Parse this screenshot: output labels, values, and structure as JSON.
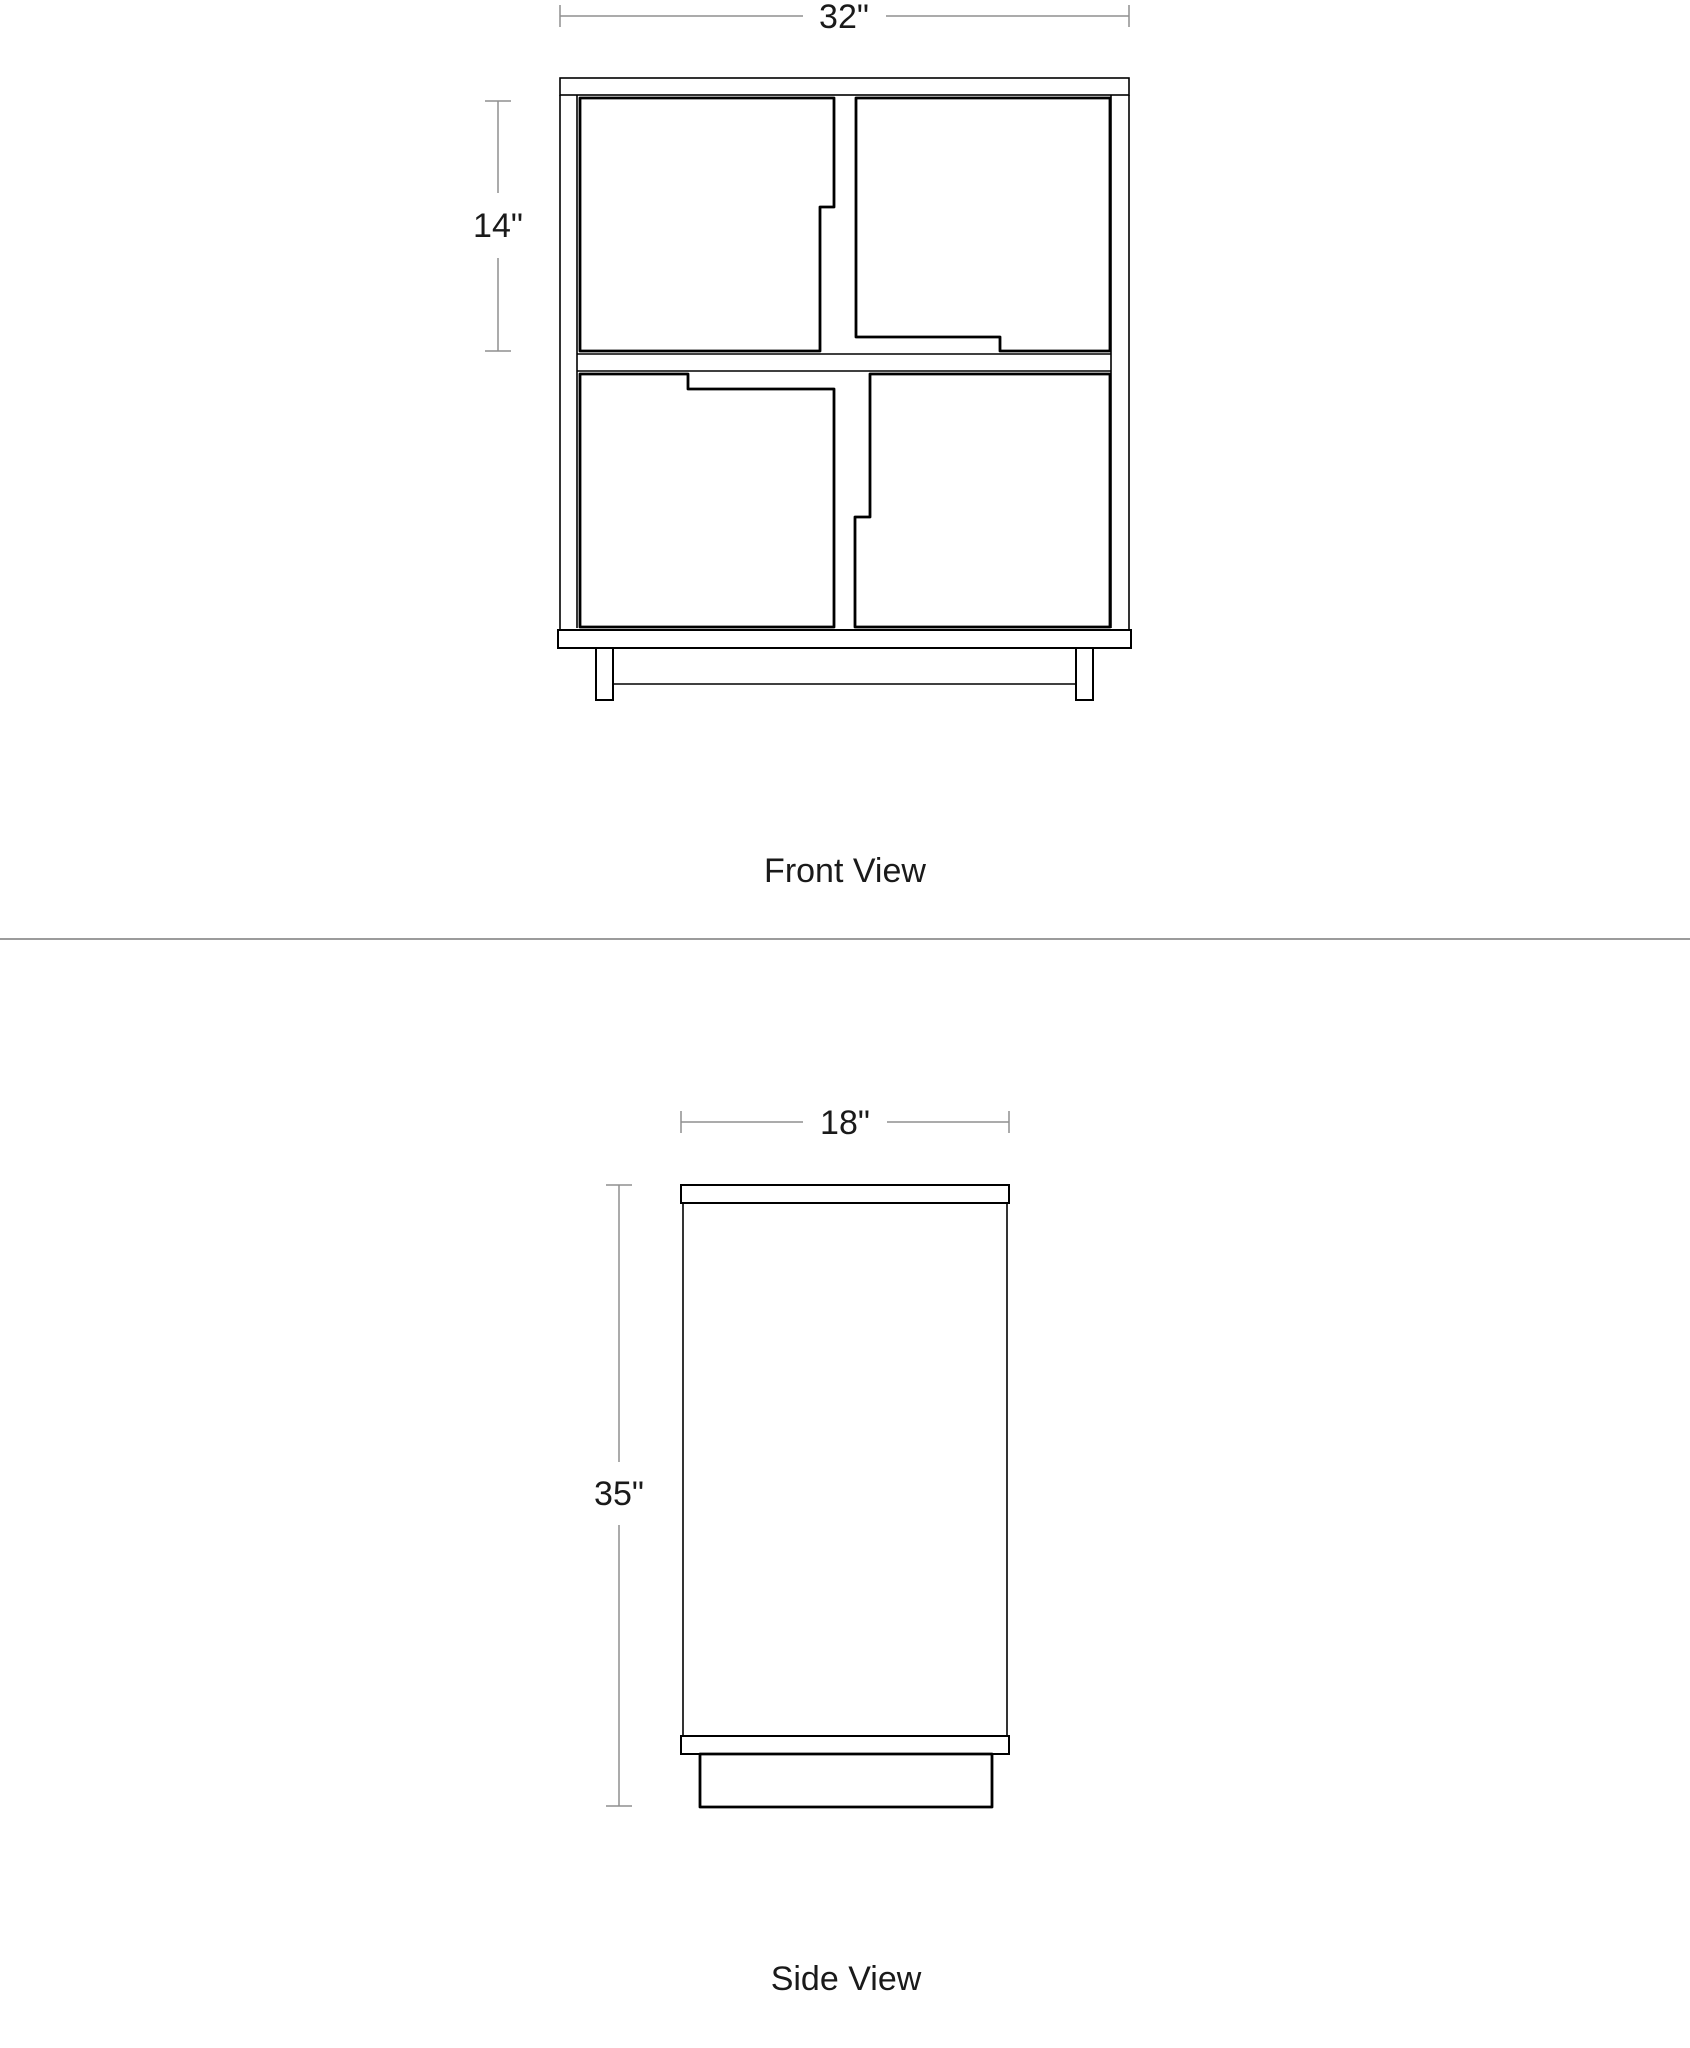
{
  "page": {
    "background": "#ffffff",
    "divider_color": "#9b9b9b",
    "drawing_line_color": "#000000",
    "dimension_line_color": "#8f8f8f",
    "text_color": "#1a1a1a"
  },
  "front_view": {
    "label": "Front View",
    "width_dim": "32\"",
    "cell_height_dim": "14\""
  },
  "side_view": {
    "label": "Side View",
    "width_dim": "18\"",
    "height_dim": "35\""
  }
}
